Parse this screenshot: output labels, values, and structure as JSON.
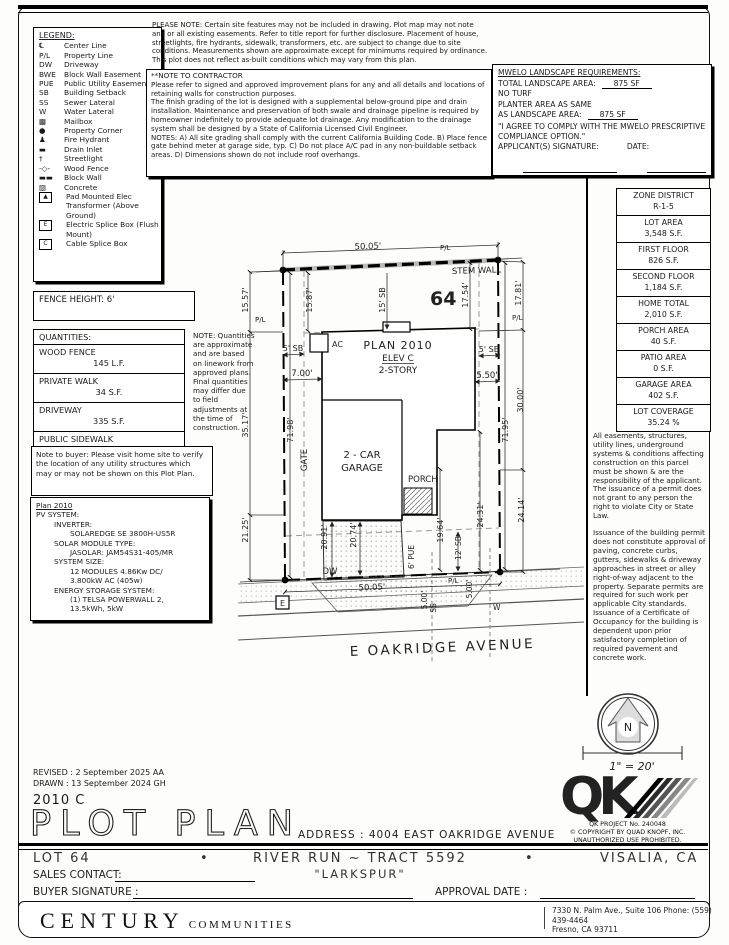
{
  "doc": {
    "please_note": "PLEASE NOTE:  Certain site features may not be included in drawing.  Plot map may not note any or all existing easements.  Refer to title report for further disclosure.  Placement of house, streetlights, fire hydrants, sidewalk, transformers, etc. are subject to change due to site conditions.  Measurements shown are approximate except for minimums required by ordinance.  This plot does not reflect as-built conditions which may vary from this plan.",
    "separator_bullet": "•"
  },
  "legend": {
    "title": "LEGEND:",
    "items": [
      {
        "sym": "℄",
        "label": "Center Line"
      },
      {
        "sym": "P/L",
        "label": "Property Line"
      },
      {
        "sym": "DW",
        "label": "Driveway"
      },
      {
        "sym": "BWE",
        "label": "Block Wall Easement"
      },
      {
        "sym": "PUE",
        "label": "Public Utility Easement"
      },
      {
        "sym": "SB",
        "label": "Building Setback"
      },
      {
        "sym": "SS",
        "label": "Sewer Lateral"
      },
      {
        "sym": "W",
        "label": "Water Lateral"
      },
      {
        "sym": "▩",
        "label": "Mailbox"
      },
      {
        "sym": "●",
        "label": "Property Corner"
      },
      {
        "sym": "♟",
        "label": "Fire Hydrant"
      },
      {
        "sym": "▬",
        "label": "Drain Inlet"
      },
      {
        "sym": "†",
        "label": "Streetlight"
      },
      {
        "sym": "-◇-",
        "label": "Wood Fence"
      },
      {
        "sym": "▬▬",
        "label": "Block Wall"
      },
      {
        "sym": "▨",
        "label": "Concrete"
      },
      {
        "sym": "▲",
        "label": "Pad Mounted Elec Transformer (Above Ground)"
      },
      {
        "sym": "E",
        "label": "Electric Splice Box (Flush Mount)"
      },
      {
        "sym": "C",
        "label": "Cable Splice Box"
      }
    ]
  },
  "contractor": {
    "title": "**NOTE TO CONTRACTOR",
    "p1": "Please refer to signed and approved improvement plans for any and all details and locations of retaining walls for construction purposes.",
    "p2": "The finish grading of the lot is designed with a supplemental below-ground pipe and drain installation.  Maintenance and preservation of both swale and drainage pipeline is required by homeowner indefinitely to provide adequate lot drainage.  Any modification to the drainage system shall be designed by a State of California Licensed Civil Engineer.",
    "p3": "NOTES:  A) All site grading shall comply with the current California Building Code. B) Place fence gate behind meter at garage side, typ.  C) Do not place A/C pad in any non-buildable setback areas.  D) Dimensions shown do not include roof overhangs."
  },
  "mwelo": {
    "title": "MWELO LANDSCAPE REQUIREMENTS:",
    "total_label": "TOTAL LANDSCAPE AREA:",
    "total_value": "875 SF",
    "no_turf": "NO TURF",
    "planter_line1": "PLANTER AREA AS SAME",
    "planter_label": "AS LANDSCAPE AREA:",
    "planter_value": "875 SF",
    "quote": "\"I AGREE TO COMPLY WITH THE MWELO PRESCRIPTIVE COMPLIANCE OPTION.\"",
    "signature_label": "APPLICANT(S) SIGNATURE:",
    "date_label": "DATE:"
  },
  "zone": {
    "rows": [
      {
        "label": "ZONE DISTRICT",
        "value": "R-1-5"
      },
      {
        "label": "LOT AREA",
        "value": "3,548 S.F."
      },
      {
        "label": "FIRST FLOOR",
        "value": "826 S.F."
      },
      {
        "label": "SECOND FLOOR",
        "value": "1,184 S.F."
      },
      {
        "label": "HOME TOTAL",
        "value": "2,010 S.F."
      },
      {
        "label": "PORCH AREA",
        "value": "40 S.F."
      },
      {
        "label": "PATIO AREA",
        "value": "0 S.F."
      },
      {
        "label": "GARAGE AREA",
        "value": "402 S.F."
      },
      {
        "label": "LOT COVERAGE",
        "value": "35.24 %"
      }
    ]
  },
  "easements": {
    "p1": "All easements, structures, utility lines, underground systems & conditions affecting construction on this parcel must be shown & are the responsibility of the applicant. The issuance of a permit does not grant to any person the right to violate City or State Law.",
    "p2": "Issuance of the building permit does not constitute approval of paving, concrete curbs, gutters, sidewalks & driveway approaches in street or alley right-of-way adjacent to the property. Separate permits are required for such work per applicable City standards. Issuance of a Certificate of Occupancy for the building is dependent upon prior satisfactory completion of required pavement and concrete work."
  },
  "fence_height": "FENCE HEIGHT: 6'",
  "quantities": {
    "title": "QUANTITIES:",
    "rows": [
      {
        "label": "WOOD FENCE",
        "value": "145 L.F."
      },
      {
        "label": "PRIVATE WALK",
        "value": "34 S.F."
      },
      {
        "label": "DRIVEWAY",
        "value": "335 S.F."
      },
      {
        "label": "PUBLIC SIDEWALK",
        "value": "350 S.F."
      }
    ],
    "note": "NOTE: Quantities are approximate and are based on linework from approved plans.  Final quantities may differ due to field adjustments at the time of construction."
  },
  "buyer_note": "Note to buyer: Please visit home site to verify the location of any utility structures which may or may not be shown on this Plot Plan.",
  "pv": {
    "title": "Plan 2010",
    "l1": "PV SYSTEM:",
    "l2": "INVERTER:",
    "l3": "SOLAREDGE SE 3800H-US5R",
    "l4": "SOLAR MODULE TYPE:",
    "l5": "JASOLAR: JAM54S31-405/MR",
    "l6": "SYSTEM SIZE:",
    "l7": "12 MODULES 4.86Kw DC/",
    "l8": "3.800kW AC (405w)",
    "l9": "ENERGY STORAGE SYSTEM:",
    "l10": "(1) TELSA POWERWALL 2,",
    "l11": "13.5kWh, 5kW"
  },
  "drawing": {
    "dim_top_width": "50.05'",
    "stem_wall": "STEM WALL",
    "lot_number": "64",
    "pl": "P/L",
    "dim_15_57": "15.57'",
    "dim_15_87": "15.87'",
    "sb_15": "15' SB",
    "dim_17_54": "17.54'",
    "dim_17_81": "17.81'",
    "plan_name": "PLAN 2010",
    "elev": "ELEV C",
    "story": "2-STORY",
    "ac": "AC",
    "sb_5": "5' SB",
    "dim_7_00": "7.00'",
    "dim_5_50": "5.50'",
    "dim_30_00": "30.00'",
    "dim_71_95": "71.95'",
    "dim_71_98": "71.98'",
    "dim_35_17": "35.17'",
    "gate": "GATE",
    "garage_line1": "2 - CAR",
    "garage_line2": "GARAGE",
    "porch": "PORCH",
    "dim_21_25": "21.25'",
    "dim_20_91": "20.91'",
    "dim_20_74": "20.74'",
    "dw": "DW",
    "dim_bottom_width": "50.05'",
    "pue": "6' PUE",
    "dim_19_64": "19.64'",
    "sb_12": "12' SB",
    "dim_24_31": "24.31'",
    "dim_24_14": "24.14'",
    "dim_5_00": "5.00'",
    "ss": "SS",
    "w": "W",
    "e": "E",
    "street": "E OAKRIDGE AVENUE"
  },
  "compass": {
    "n": "N"
  },
  "scale": {
    "text": "1\" = 20'"
  },
  "title_block": {
    "revised": "REVISED :  2 September 2025  AA",
    "drawn": "DRAWN :  13 September 2024  GH",
    "plan_code": "2010 C",
    "title": "PLOT PLAN",
    "address": "ADDRESS :  4004 EAST OAKRIDGE AVENUE",
    "lot": "LOT 64",
    "tract": "RIVER RUN ~ TRACT 5592",
    "city": "VISALIA, CA",
    "model": "\"LARKSPUR\"",
    "sales_contact": "SALES CONTACT:",
    "buyer_signature": "BUYER SIGNATURE :",
    "approval_date": "APPROVAL DATE :"
  },
  "qk": {
    "mark": "QK",
    "project": "QK PROJECT No. 240048",
    "copyright": "©   COPYRIGHT BY QUAD KNOPF, INC.",
    "unauthorized": "UNAUTHORIZED USE PROHIBITED."
  },
  "footer": {
    "company": "CENTURY",
    "company2": "COMMUNITIES",
    "addr1": "7330 N. Palm Ave., Suite 106    Phone:  (559) 439-4464",
    "addr2": "Fresno, CA  93711"
  }
}
